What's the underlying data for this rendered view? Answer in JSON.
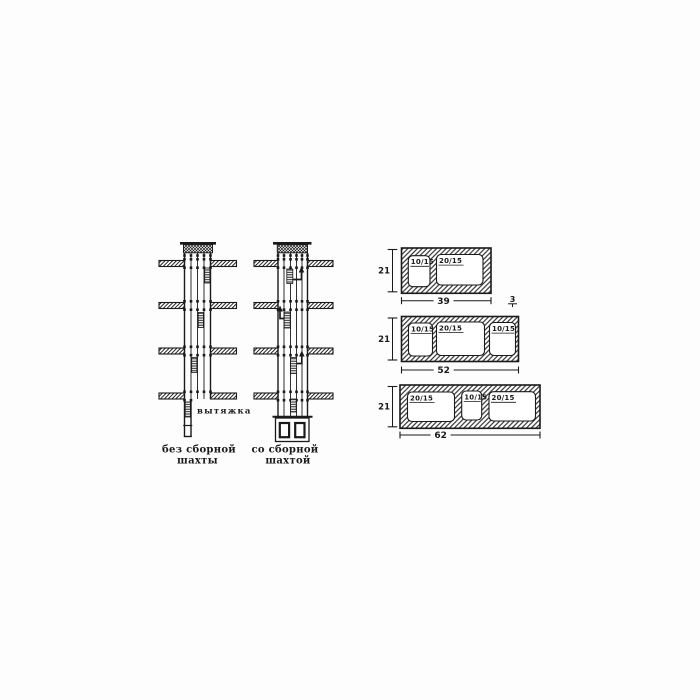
{
  "canvas": {
    "background": "#fdfdfd",
    "ink": "#1a1a1a"
  },
  "shaft_diagrams": {
    "exhaust_label": "вытяжка",
    "left": {
      "caption_line1": "без сборной",
      "caption_line2": "шахты"
    },
    "right": {
      "caption_line1": "со сборной",
      "caption_line2": "шахтой"
    }
  },
  "vent_blocks": [
    {
      "height_label": "21",
      "width_label": "39",
      "wall_thickness_label": "3",
      "openings": [
        "10/15",
        "20/15"
      ]
    },
    {
      "height_label": "21",
      "width_label": "52",
      "openings": [
        "10/15",
        "20/15",
        "10/15"
      ]
    },
    {
      "height_label": "21",
      "width_label": "62",
      "openings": [
        "20/15",
        "10/15",
        "20/15"
      ]
    }
  ]
}
